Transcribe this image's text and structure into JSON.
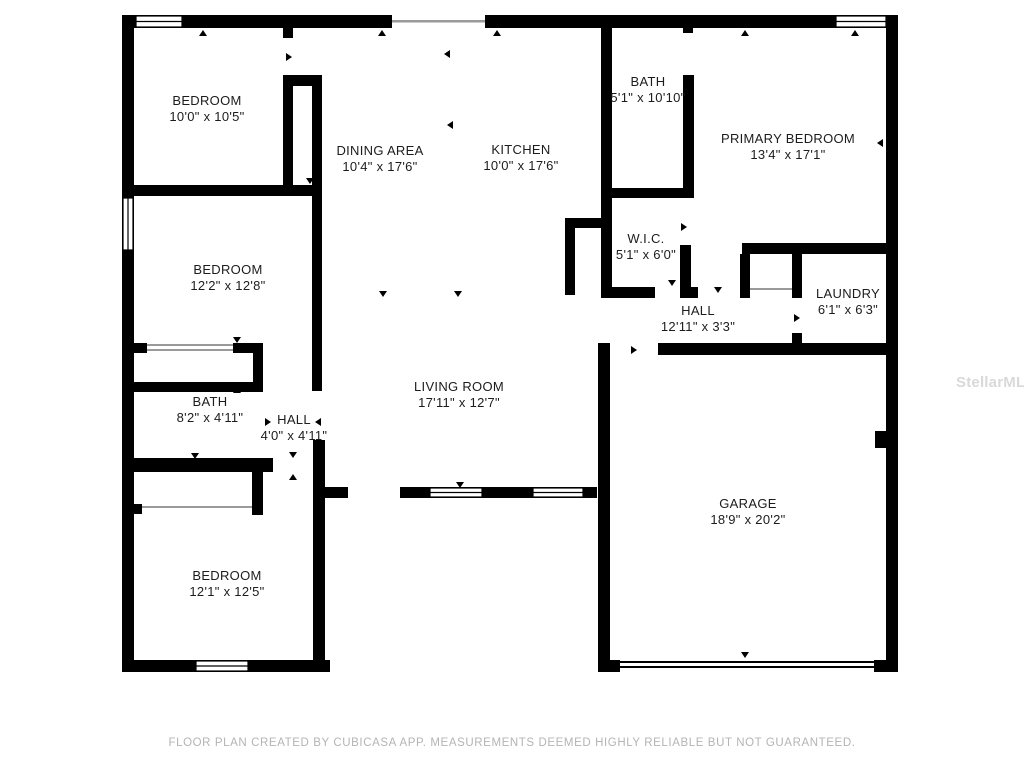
{
  "watermark": "StellarMLS",
  "footer": "FLOOR PLAN CREATED BY CUBICASA APP. MEASUREMENTS DEEMED HIGHLY RELIABLE BUT NOT GUARANTEED.",
  "rooms": [
    {
      "name": "BEDROOM",
      "dims": "10'0\" x 10'5\"",
      "x": 207,
      "y": 109
    },
    {
      "name": "DINING AREA",
      "dims": "10'4\" x 17'6\"",
      "x": 380,
      "y": 159
    },
    {
      "name": "KITCHEN",
      "dims": "10'0\" x 17'6\"",
      "x": 521,
      "y": 158
    },
    {
      "name": "BATH",
      "dims": "5'1\" x 10'10\"",
      "x": 648,
      "y": 90
    },
    {
      "name": "PRIMARY BEDROOM",
      "dims": "13'4\" x 17'1\"",
      "x": 788,
      "y": 147
    },
    {
      "name": "W.I.C.",
      "dims": "5'1\" x 6'0\"",
      "x": 646,
      "y": 247
    },
    {
      "name": "HALL",
      "dims": "12'11\" x 3'3\"",
      "x": 698,
      "y": 319
    },
    {
      "name": "LAUNDRY",
      "dims": "6'1\" x 6'3\"",
      "x": 848,
      "y": 302
    },
    {
      "name": "BEDROOM",
      "dims": "12'2\" x 12'8\"",
      "x": 228,
      "y": 278
    },
    {
      "name": "BATH",
      "dims": "8'2\" x 4'11\"",
      "x": 210,
      "y": 410
    },
    {
      "name": "HALL",
      "dims": "4'0\" x 4'11\"",
      "x": 294,
      "y": 428
    },
    {
      "name": "LIVING ROOM",
      "dims": "17'11\" x 12'7\"",
      "x": 459,
      "y": 395
    },
    {
      "name": "GARAGE",
      "dims": "18'9\" x 20'2\"",
      "x": 748,
      "y": 512
    },
    {
      "name": "BEDROOM",
      "dims": "12'1\" x 12'5\"",
      "x": 227,
      "y": 584
    }
  ]
}
